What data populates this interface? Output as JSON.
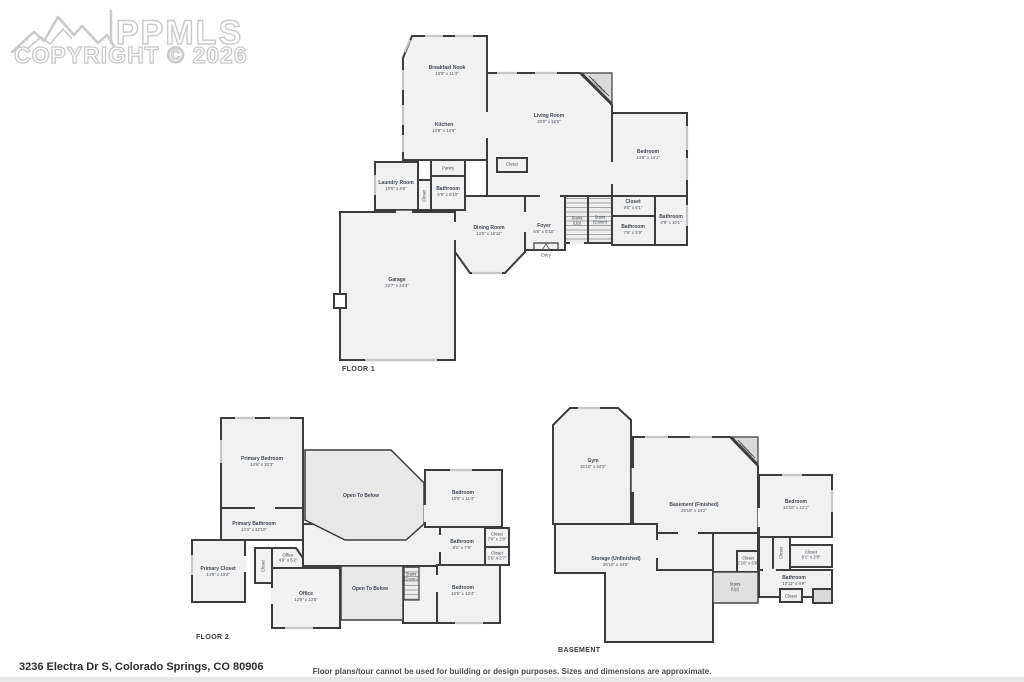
{
  "watermark": {
    "logo": "PPMLS",
    "copyright": "COPYRIGHT © 2026"
  },
  "footer": {
    "address": "3236 Electra Dr S, Colorado Springs, CO 80906",
    "disclaimer": "Floor plans/tour cannot be used for building or design purposes. Sizes and dimensions are approximate."
  },
  "colors": {
    "wall": "#3c3c3c",
    "room_fill": "#f1f1f1",
    "open_fill": "#e8e8e8",
    "window": "#c6c6c6"
  },
  "floors": [
    {
      "label": "FLOOR 1",
      "rooms": [
        {
          "name": "Breakfast Nook",
          "dims": "10'8\" x 11'4\""
        },
        {
          "name": "Kitchen",
          "dims": "10'9\" x 14'5\""
        },
        {
          "name": "Living Room",
          "dims": "20'0\" x 16'6\""
        },
        {
          "name": "Fireplace"
        },
        {
          "name": "Bedroom",
          "dims": "14'8\" x 14'1\""
        },
        {
          "name": "Closet"
        },
        {
          "name": "Pantry"
        },
        {
          "name": "Laundry Room",
          "dims": "10'5\" x 6'6\""
        },
        {
          "name": "Bathroom",
          "dims": "5'9\" x 6'10\""
        },
        {
          "name": "Closet"
        },
        {
          "name": "Dining Room",
          "dims": "13'6\" x 16'11\""
        },
        {
          "name": "Foyer",
          "dims": "6'6\" x 5'10\""
        },
        {
          "name": "Entry"
        },
        {
          "name": "Stairs",
          "sub": "(Up)"
        },
        {
          "name": "Stairs",
          "sub": "(Down)"
        },
        {
          "name": "Closet",
          "dims": "9'8\" x 5'1\""
        },
        {
          "name": "Bathroom",
          "dims": "7'6\" x 5'9\""
        },
        {
          "name": "Bathroom",
          "dims": "4'8\" x 10'1\""
        },
        {
          "name": "Garage",
          "dims": "22'7\" x 24'3\""
        }
      ]
    },
    {
      "label": "FLOOR 2",
      "rooms": [
        {
          "name": "Primary Bedroom",
          "dims": "14'6\" x 20'3\""
        },
        {
          "name": "Open To Below"
        },
        {
          "name": "Bedroom",
          "dims": "10'8\" x 11'4\""
        },
        {
          "name": "Primary Bathroom",
          "dims": "13'4\" x 12'10\""
        },
        {
          "name": "Bathroom",
          "dims": "8'1\" x 7'8\""
        },
        {
          "name": "Closet",
          "dims": "7'4\" x 2'8\""
        },
        {
          "name": "Closet",
          "dims": "5'6\" x 2'7\""
        },
        {
          "name": "Primary Closet",
          "dims": "14'9\" x 13'2\""
        },
        {
          "name": "Office",
          "dims": "4'9\" x 5'2\""
        },
        {
          "name": "Closet"
        },
        {
          "name": "Office",
          "dims": "13'9\" x 13'5\""
        },
        {
          "name": "Open To Below"
        },
        {
          "name": "Stairs",
          "sub": "(Down)"
        },
        {
          "name": "Bedroom",
          "dims": "10'6\" x 13'4\""
        }
      ]
    },
    {
      "label": "BASEMENT",
      "rooms": [
        {
          "name": "Gym",
          "dims": "15'10\" x 24'0\""
        },
        {
          "name": "Basement (Finished)",
          "dims": "25'10\" x 24'2\""
        },
        {
          "name": "Fireplace"
        },
        {
          "name": "Bedroom",
          "dims": "14'10\" x 12'1\""
        },
        {
          "name": "Closet",
          "dims": "8'1\" x 2'8\""
        },
        {
          "name": "Closet"
        },
        {
          "name": "Closet",
          "dims": "2'10\" x 5'8\""
        },
        {
          "name": "Storage (Unfinished)",
          "dims": "26'10\" x 24'5\""
        },
        {
          "name": "Stairs",
          "sub": "(Up)"
        },
        {
          "name": "Bathroom",
          "dims": "10'11\" x 4'9\""
        },
        {
          "name": "Closet"
        }
      ]
    }
  ]
}
